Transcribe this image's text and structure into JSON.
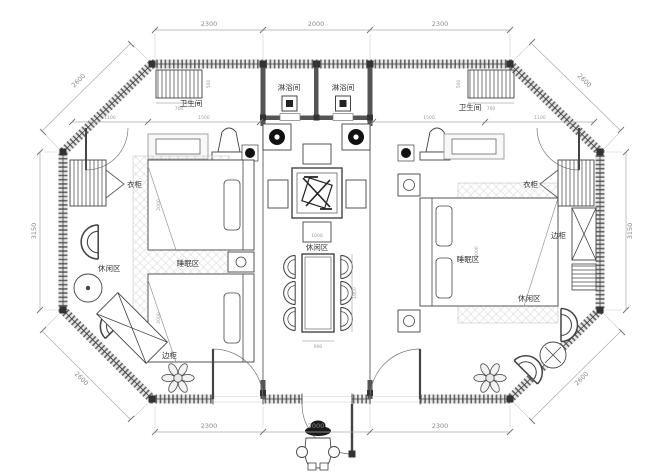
{
  "labels": {
    "shower_left": "淋浴间",
    "shower_right": "淋浴间",
    "bath_left": "卫生间",
    "bath_right": "卫生间",
    "wardrobe_left": "衣柜",
    "wardrobe_right": "衣柜",
    "side_cabinet_left": "边柜",
    "side_cabinet_right": "边柜",
    "leisure_left": "休闲区",
    "leisure_center": "休闲区",
    "leisure_right": "休闲区",
    "sleep_left": "睡眠区",
    "sleep_right": "睡眠区"
  },
  "dimensions": {
    "top": [
      "2300",
      "2000",
      "2300"
    ],
    "bottom": [
      "2300",
      "2000",
      "2300"
    ],
    "left": "3150",
    "right": "3150",
    "diag_top_left": "2600",
    "diag_top_right": "2600",
    "diag_bottom_left": "2600",
    "diag_bottom_right": "2600",
    "interior": {
      "radiator": "700",
      "radiator_side": "500",
      "bath_inner": "1100",
      "bath_outer": "1500",
      "bed_length": "2000",
      "table_width": "900",
      "table_length": "1800",
      "tea_table": "1000"
    }
  },
  "colors": {
    "wall": "#555555",
    "line": "#333333",
    "dim": "#999999",
    "accent": "#111111",
    "paper": "#ffffff"
  }
}
